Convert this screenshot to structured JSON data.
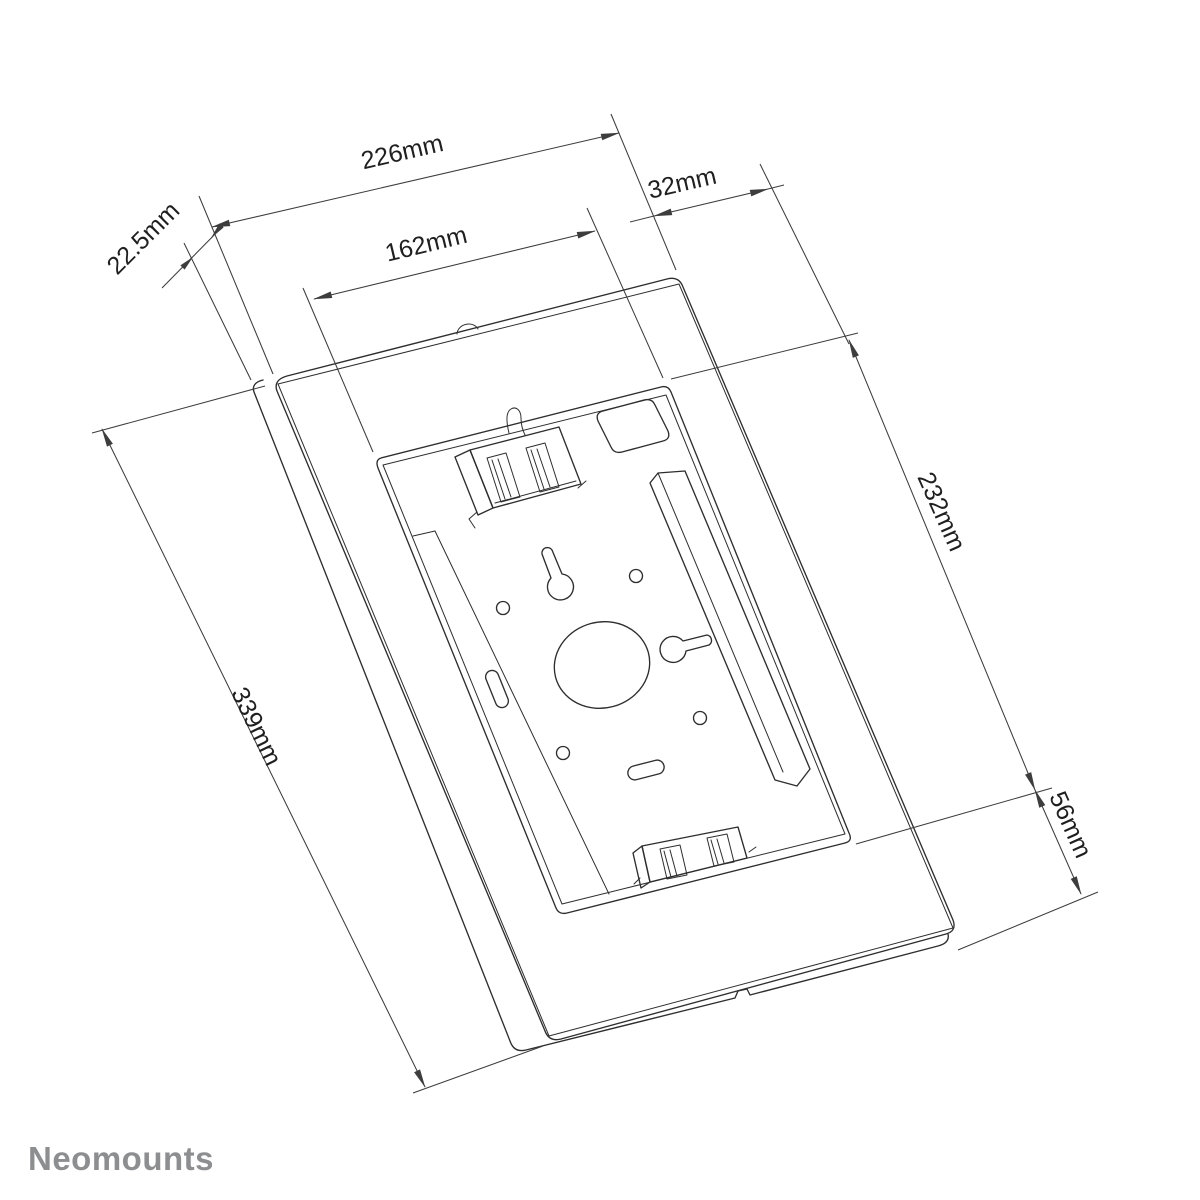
{
  "page": {
    "background_color": "#ffffff"
  },
  "drawing": {
    "description": "3D technical line drawing of a tablet enclosure wall mount with dimension callouts",
    "line_color": "#2e2e2e",
    "dimension_color": "#3d3d3d",
    "dimensions": {
      "total_width": {
        "label": "226mm",
        "value": 226,
        "unit": "mm"
      },
      "window_width": {
        "label": "162mm",
        "value": 162,
        "unit": "mm"
      },
      "side_offset": {
        "label": "32mm",
        "value": 32,
        "unit": "mm"
      },
      "bezel_lip": {
        "label": "22.5mm",
        "value": 22.5,
        "unit": "mm"
      },
      "window_height": {
        "label": "232mm",
        "value": 232,
        "unit": "mm"
      },
      "depth": {
        "label": "56mm",
        "value": 56,
        "unit": "mm"
      },
      "total_height": {
        "label": "339mm",
        "value": 339,
        "unit": "mm"
      }
    }
  },
  "footer": {
    "logo_text": "Neomounts",
    "logo_color": "#8d8e90"
  }
}
